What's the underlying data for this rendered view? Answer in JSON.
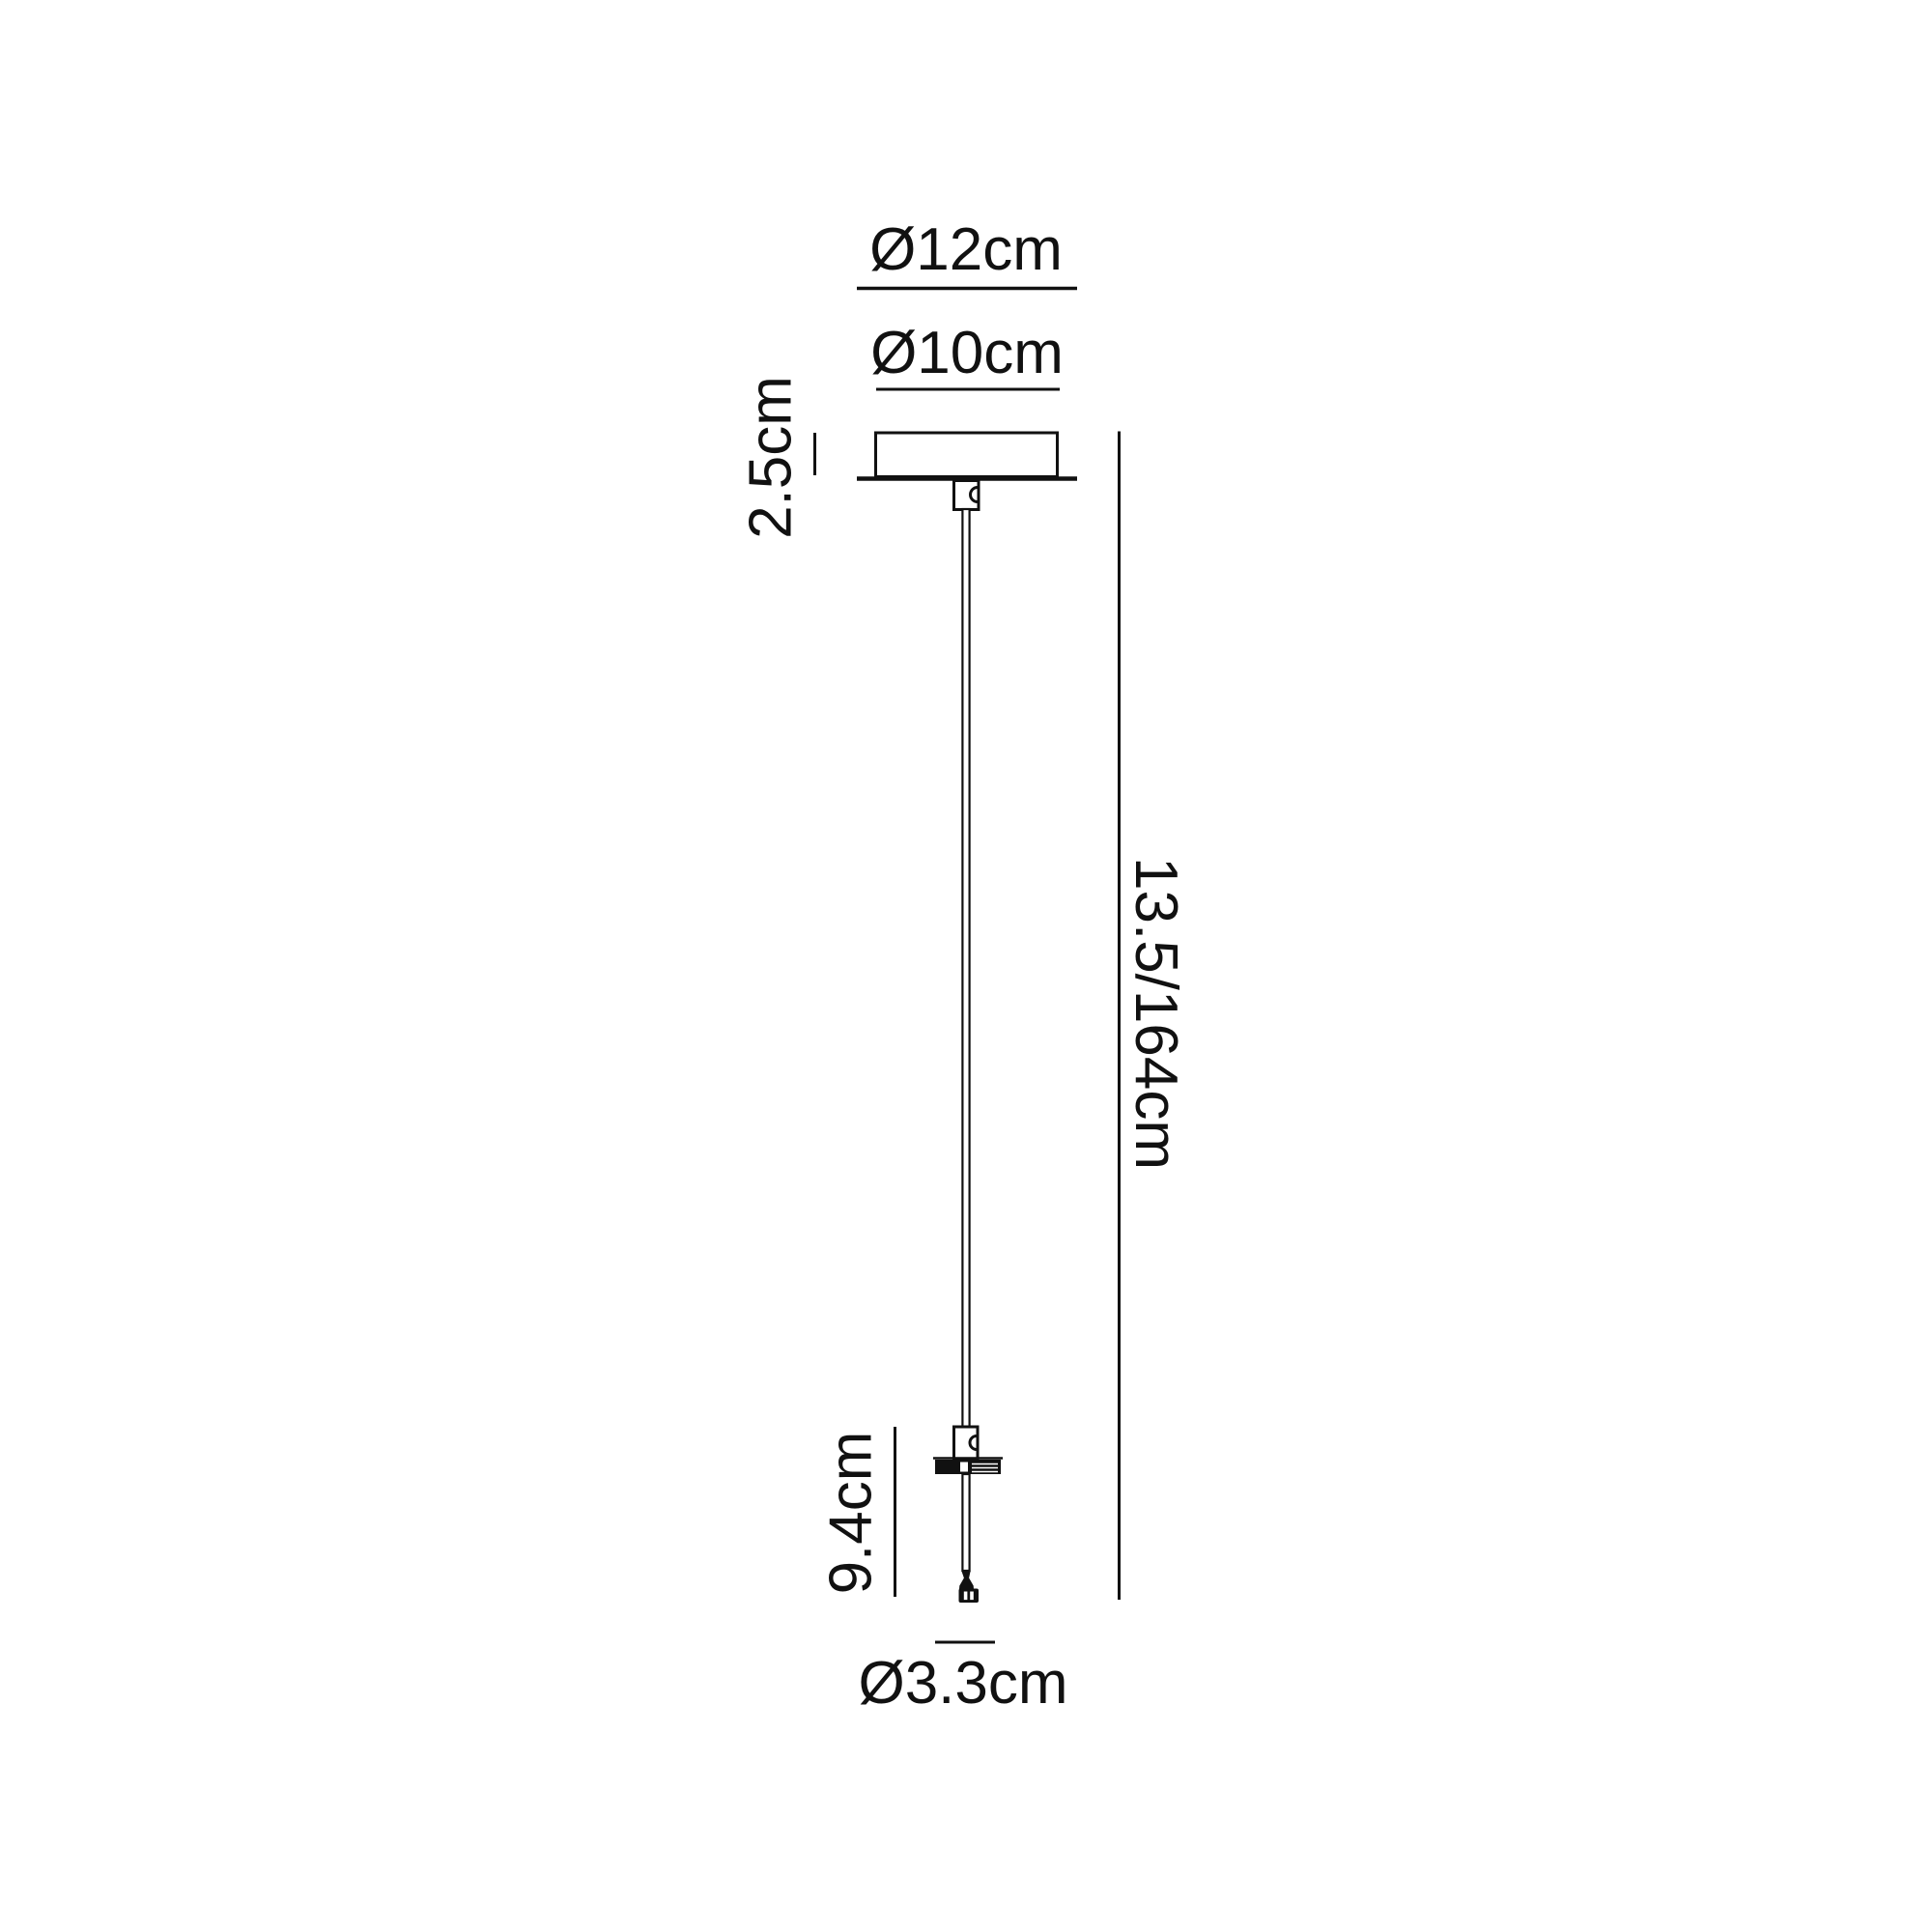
{
  "page": {
    "background": "#ffffff",
    "ink": "#111111"
  },
  "diagram": {
    "kind": "pendant-light-suspension-kit-dimension-drawing",
    "labels": {
      "plate_diameter": "Ø12cm",
      "canopy_diameter": "Ø10cm",
      "canopy_height": "2.5cm",
      "drop_length": "13.5/164cm",
      "lower_assembly_height": "9.4cm",
      "connector_diameter": "Ø3.3cm"
    }
  }
}
